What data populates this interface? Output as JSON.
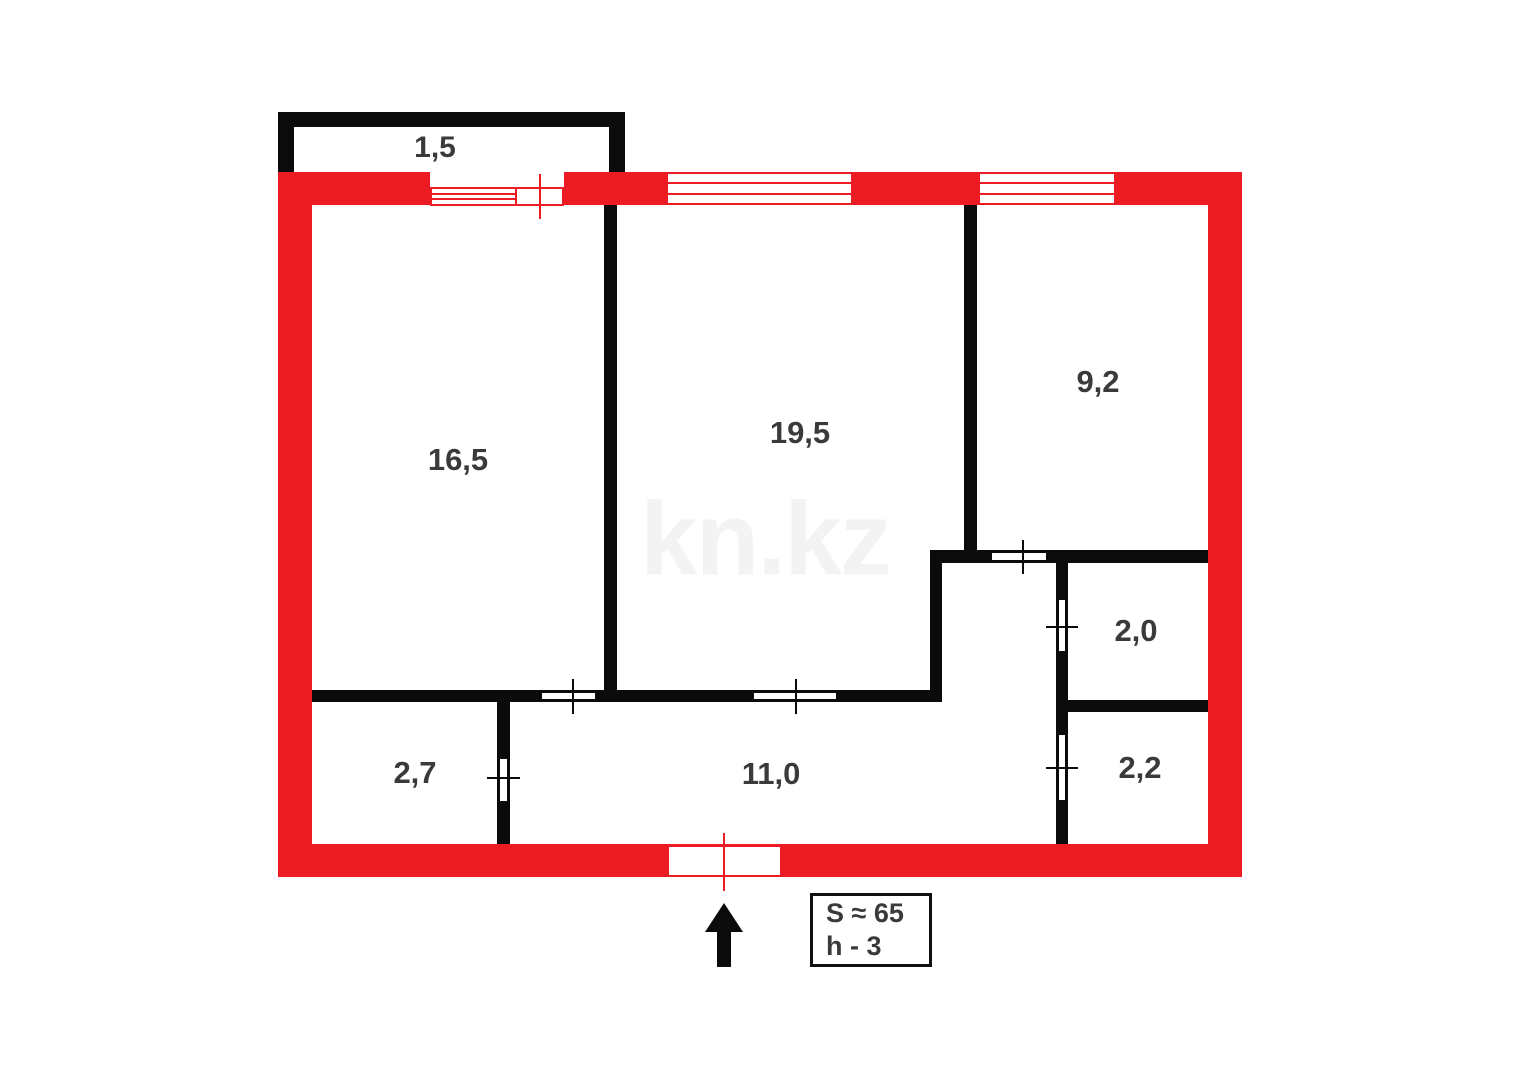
{
  "watermark": "kn.kz",
  "colors": {
    "outer_wall_red": "#ED1C24",
    "interior_wall_black": "#0B0B0B",
    "label_gray": "#3A3A3A"
  },
  "rooms": {
    "balcony": "1,5",
    "room_living_left": "16,5",
    "room_living_mid": "19,5",
    "room_top_right": "9,2",
    "room_wc": "2,0",
    "room_bath": "2,2",
    "room_small_left": "2,7",
    "corridor": "11,0"
  },
  "info_box": {
    "area_line": "S ≈ 65",
    "height_line": "h - 3"
  }
}
